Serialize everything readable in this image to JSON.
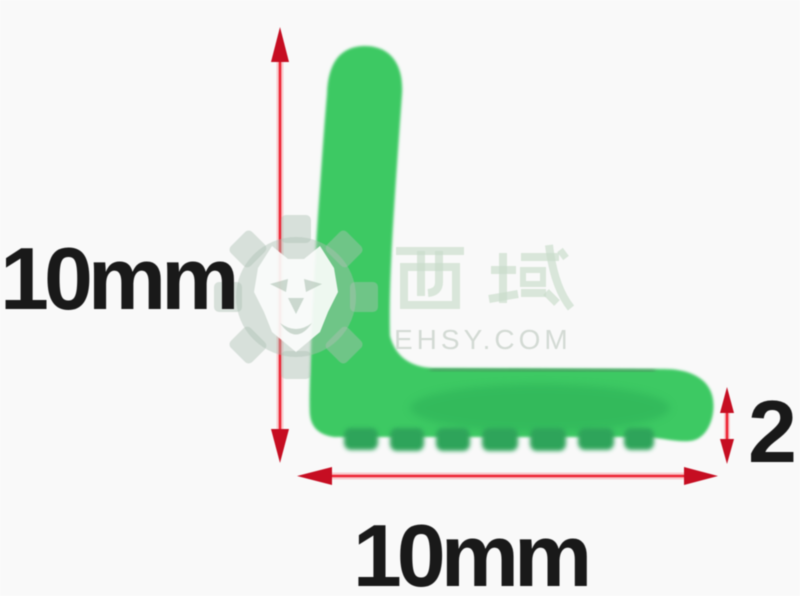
{
  "page": {
    "background_color": "#f9f9f9",
    "description": "Product dimension diagram of a green L-shaped edge trim profile"
  },
  "dimensions": {
    "height_label": "10mm",
    "width_label": "10mm",
    "thickness_label": "2"
  },
  "shape": {
    "kind": "L-profile",
    "fill_color": "#3ec963",
    "rib_color": "#2da45a"
  },
  "arrows": {
    "shaft_color": "#ee2434",
    "head_color": "#c60e22"
  },
  "watermark": {
    "cjk": "西域",
    "site": "EHSY.COM",
    "logo": "gear-lion",
    "color": "#dcе9de"
  }
}
